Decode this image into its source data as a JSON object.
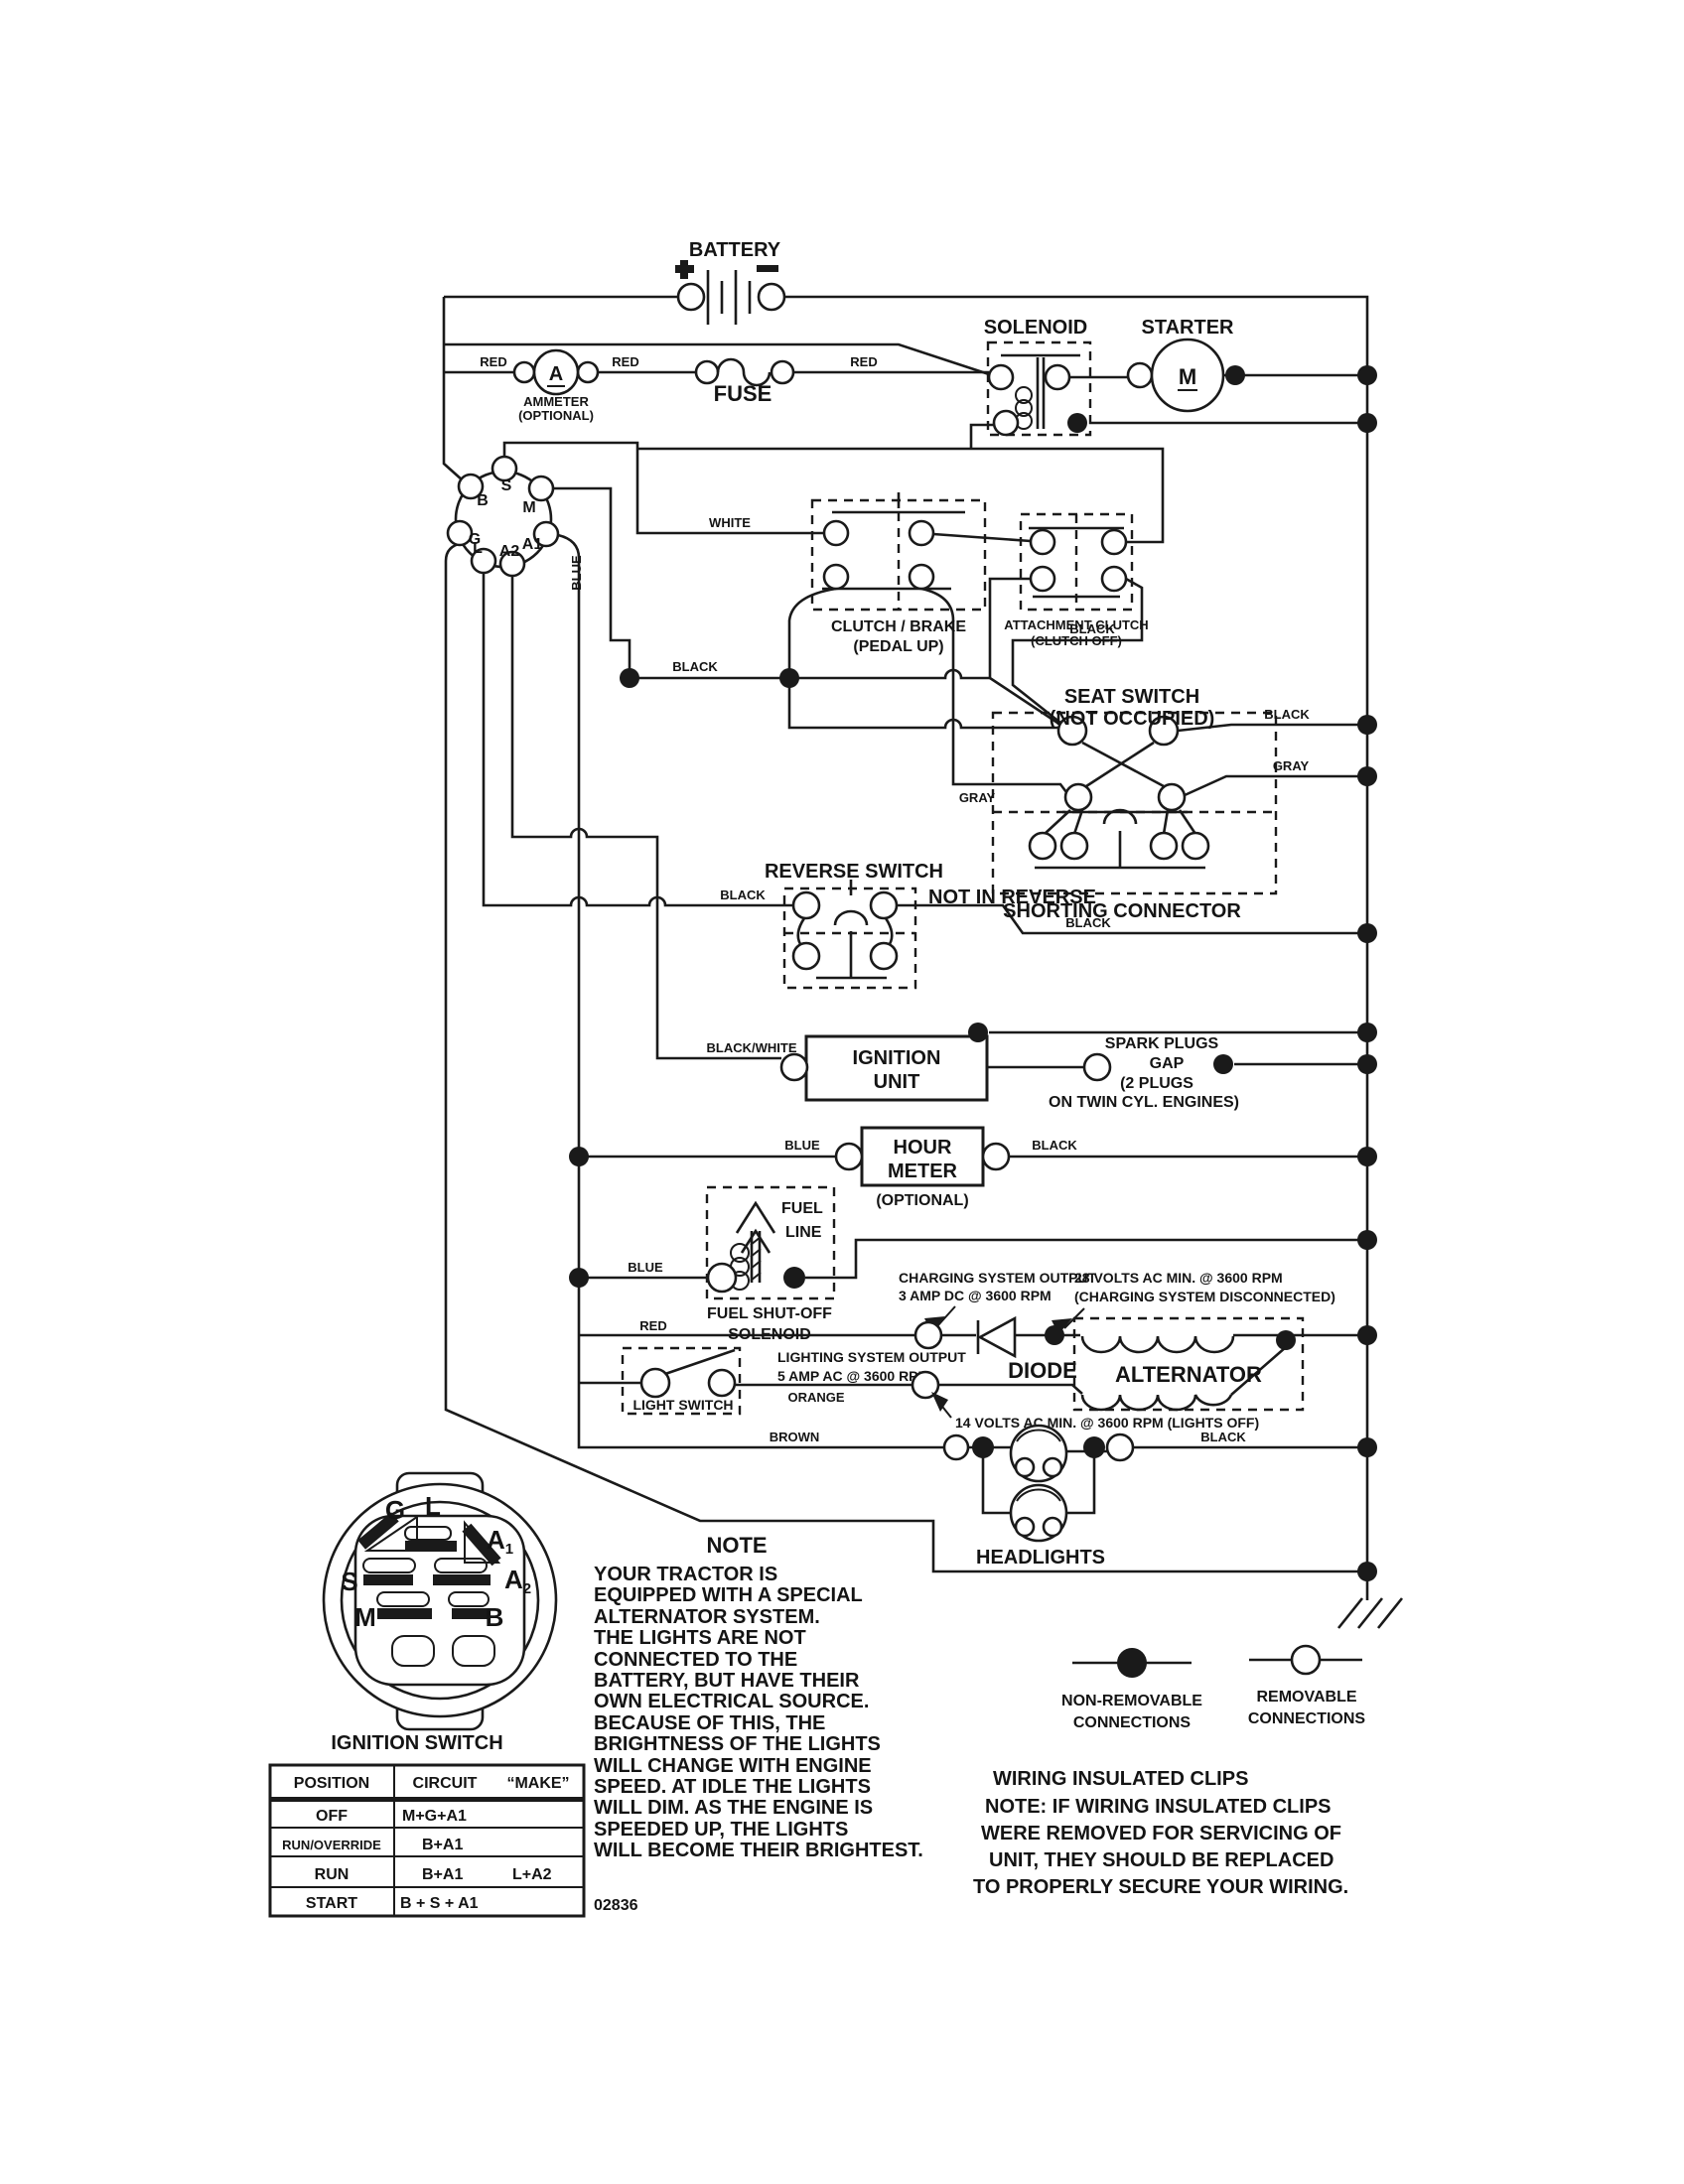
{
  "colors": {
    "ink": "#1a1a1a",
    "paper": "#ffffff"
  },
  "battery": {
    "label": "BATTERY",
    "plus": "+"
  },
  "ammeter": {
    "symbol": "A",
    "line1": "AMMETER",
    "line2": "(OPTIONAL)"
  },
  "fuse": {
    "label": "FUSE"
  },
  "solenoid": {
    "label": "SOLENOID"
  },
  "starter": {
    "label": "STARTER",
    "symbol": "M"
  },
  "connector": {
    "b": "B",
    "s": "S",
    "m": "M",
    "g": "G",
    "a1": "A1",
    "l": "L",
    "a2": "A2"
  },
  "wires": {
    "red": "RED",
    "white": "WHITE",
    "blue": "BLUE",
    "black": "BLACK",
    "gray": "GRAY",
    "orange": "ORANGE",
    "brown": "BROWN",
    "black_white": "BLACK/WHITE"
  },
  "clutch_brake": {
    "line1": "CLUTCH / BRAKE",
    "line2": "(PEDAL UP)"
  },
  "attachment_clutch": {
    "line1": "ATTACHMENT CLUTCH",
    "line2": "(CLUTCH OFF)"
  },
  "seat_switch": {
    "line1": "SEAT SWITCH",
    "line2": "(NOT OCCUPIED)",
    "shorting": "SHORTING CONNECTOR"
  },
  "reverse_switch": {
    "label": "REVERSE SWITCH",
    "status": "NOT IN REVERSE"
  },
  "ignition_unit": {
    "line1": "IGNITION",
    "line2": "UNIT"
  },
  "spark_plugs": {
    "line1": "SPARK PLUGS",
    "line2": "GAP",
    "line3": "(2 PLUGS",
    "line4": "ON TWIN CYL. ENGINES)"
  },
  "hour_meter": {
    "line1": "HOUR",
    "line2": "METER",
    "optional": "(OPTIONAL)"
  },
  "fuel": {
    "line1": "FUEL",
    "line2": "LINE",
    "sol1": "FUEL SHUT-OFF",
    "sol2": "SOLENOID"
  },
  "charging": {
    "line1": "CHARGING SYSTEM OUTPUT",
    "line2": "3 AMP DC @ 3600 RPM"
  },
  "volts28": {
    "line1": "28 VOLTS AC MIN. @ 3600 RPM",
    "line2": "(CHARGING SYSTEM DISCONNECTED)"
  },
  "lighting": {
    "line1": "LIGHTING SYSTEM OUTPUT",
    "line2": "5 AMP AC @ 3600 RPM"
  },
  "diode": {
    "label": "DIODE"
  },
  "light_switch": {
    "label": "LIGHT SWITCH"
  },
  "volts14": {
    "label": "14 VOLTS AC MIN. @ 3600 RPM (LIGHTS OFF)"
  },
  "alternator": {
    "label": "ALTERNATOR"
  },
  "headlights": {
    "label": "HEADLIGHTS"
  },
  "note": {
    "title": "NOTE",
    "lines": [
      "YOUR TRACTOR IS",
      "EQUIPPED WITH A SPECIAL",
      "ALTERNATOR SYSTEM.",
      "THE LIGHTS ARE NOT",
      "CONNECTED TO THE",
      "BATTERY, BUT HAVE THEIR",
      "OWN ELECTRICAL SOURCE.",
      "BECAUSE OF THIS, THE",
      "BRIGHTNESS OF THE LIGHTS",
      "WILL CHANGE WITH ENGINE",
      "SPEED.  AT IDLE THE LIGHTS",
      "WILL DIM.  AS THE ENGINE IS",
      "SPEEDED UP, THE LIGHTS",
      "WILL BECOME THEIR BRIGHTEST."
    ]
  },
  "legend": {
    "nonremovable1": "NON-REMOVABLE",
    "removable1": "REMOVABLE",
    "connections": "CONNECTIONS"
  },
  "clips": {
    "title": "WIRING INSULATED CLIPS",
    "lines": [
      "NOTE: IF WIRING INSULATED CLIPS",
      "WERE REMOVED FOR SERVICING OF",
      "UNIT, THEY SHOULD BE REPLACED",
      "TO PROPERLY SECURE YOUR WIRING."
    ]
  },
  "ignition_switch": {
    "caption": "IGNITION SWITCH",
    "terminals": {
      "g": "G",
      "l": "L",
      "a": "A",
      "one": "1",
      "two": "2",
      "s": "S",
      "m": "M",
      "b": "B"
    },
    "table": {
      "h1": "POSITION",
      "h2": "CIRCUIT",
      "h3": "“MAKE”",
      "rows": [
        {
          "position": "OFF",
          "circuit": "M+G+A1",
          "make": ""
        },
        {
          "position": "RUN/OVERRIDE",
          "circuit": "B+A1",
          "make": ""
        },
        {
          "position": "RUN",
          "circuit": "B+A1",
          "make": "L+A2"
        },
        {
          "position": "START",
          "circuit": "B + S + A1",
          "make": ""
        }
      ]
    }
  },
  "doc_number": "02836"
}
